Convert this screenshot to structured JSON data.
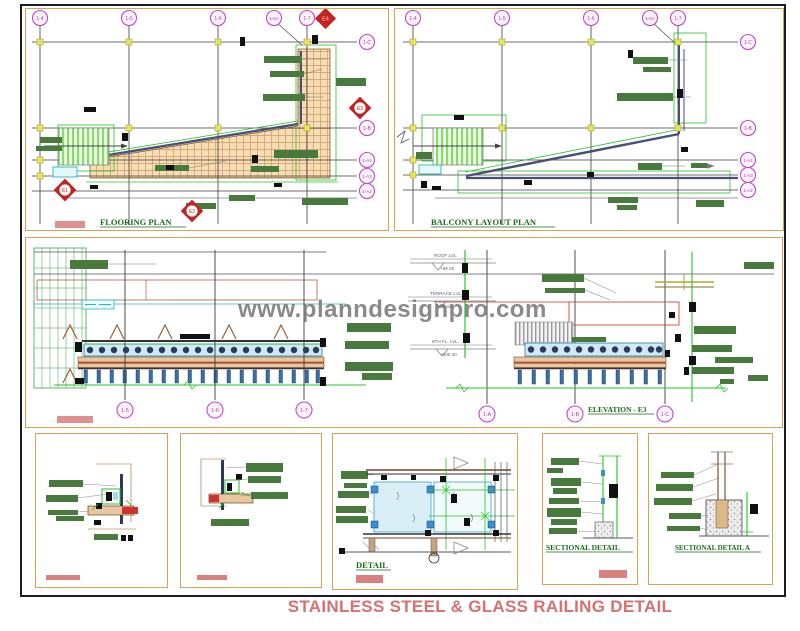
{
  "sheet": {
    "title": "STAINLESS STEEL & GLASS RAILING DETAIL",
    "watermark": "www.planndesignpro.com"
  },
  "flooring_plan": {
    "label": "FLOORING PLAN",
    "top_bubbles": [
      "1-4",
      "1-5",
      "1-6",
      "1-6A",
      "1-7"
    ],
    "right_bubbles": [
      "1-C",
      "1-B",
      "1-A4",
      "1-A3",
      "1-A2"
    ],
    "markers": {
      "top": "E4",
      "right": "E3",
      "bottom": "E2",
      "left": "E1"
    }
  },
  "balcony_plan": {
    "label": "BALCONY LAYOUT PLAN",
    "top_bubbles": [
      "1-4",
      "1-5",
      "1-6",
      "1-6A",
      "1-7"
    ],
    "right_bubbles": [
      "1-C",
      "1-B",
      "1-A4",
      "1-A3",
      "1-A2"
    ]
  },
  "elevation": {
    "label": "ELEVATION - E3",
    "left_grid_bubbles": [
      "1-5",
      "1-6",
      "1-7"
    ],
    "right_grid_bubbles": [
      "1-A",
      "1-B",
      "1-C"
    ],
    "levels": [
      {
        "name": "ROOF LVL.",
        "value": "+90.00"
      },
      {
        "name": "TERRACE LVL.",
        "value": "+60.60"
      },
      {
        "name": "6TH FL. LVL.",
        "value": "+600.30"
      }
    ]
  },
  "details": {
    "detail_label": "DETAIL",
    "sectional_detail_label": "SECTIONAL DETAIL",
    "sectional_detail_a_label": "SECTIONAL DETAIL A"
  },
  "colors": {
    "panel_border": "#d8a351",
    "grid_bubble": "#c348c3",
    "section_marker": "#c62222",
    "annotation_green": "#477a3c",
    "label_green": "#1a6b1a",
    "bright_green": "#27c427",
    "hatch_tan": "#f6ddb6",
    "glass_blue": "#cfeaf2",
    "salmon": "#e08f8f",
    "title_red": "#d96f6f",
    "watermark_grey": "#6e6e6e"
  }
}
